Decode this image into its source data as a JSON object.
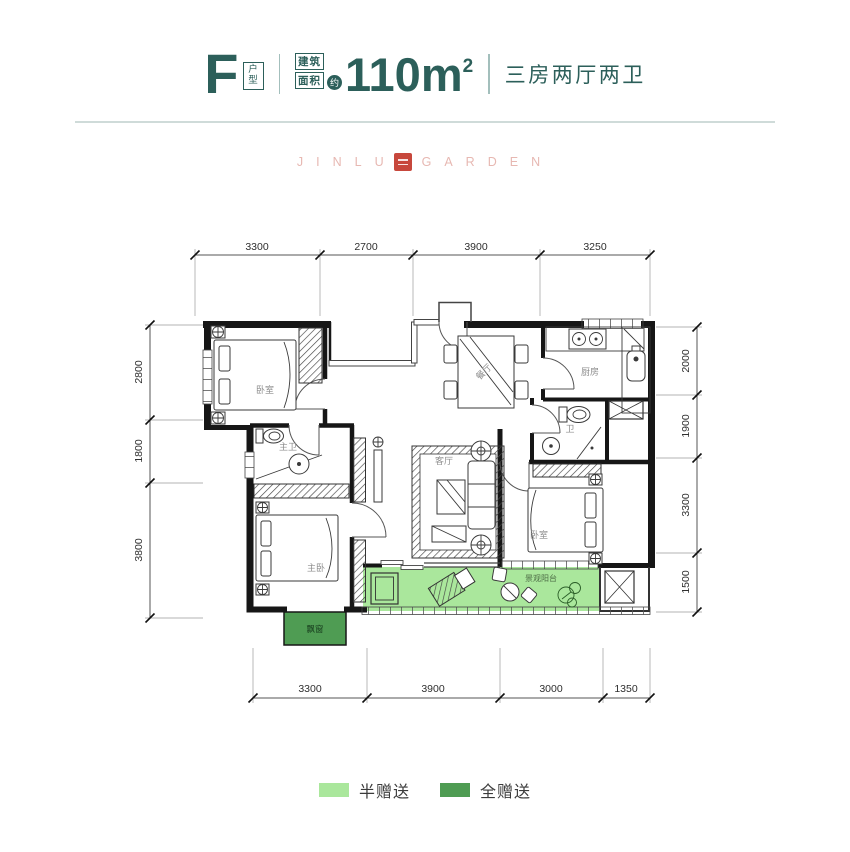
{
  "header": {
    "unit_letter": "F",
    "unit_suffix": "户型",
    "area_label_line1": "建筑",
    "area_label_line2": "面积",
    "area_approx": "约",
    "area_value": "110m",
    "area_exponent": "2",
    "layout": "三房两厅两卫"
  },
  "watermark": {
    "left": "JINLU",
    "right": "GARDEN"
  },
  "dims": {
    "top": [
      "3300",
      "2700",
      "3900",
      "3250"
    ],
    "bottom": [
      "3300",
      "3900",
      "3000",
      "1350"
    ],
    "left": [
      "2800",
      "1800",
      "3800"
    ],
    "right": [
      "2000",
      "1900",
      "3300",
      "1500"
    ]
  },
  "rooms": {
    "bedroom1": "卧室",
    "master_bath": "主卫",
    "dining": "餐厅",
    "kitchen": "厨房",
    "bath2": "卫",
    "living": "客厅",
    "master_bedroom": "主卧",
    "bedroom2": "卧室",
    "balcony": "景观阳台",
    "bay_window": "飘窗"
  },
  "legend": {
    "half": {
      "label": "半赠送",
      "color": "#aae79c"
    },
    "full": {
      "label": "全赠送",
      "color": "#4f9c53"
    }
  },
  "colors": {
    "accent_teal": "#2c5f5a",
    "wall_black": "#161616",
    "half_gift_green": "#aae79c",
    "full_gift_green": "#4f9c53",
    "watermark_pink": "#e7b8b2",
    "seal_red": "#c7473c",
    "dim_text": "#2f2f2f",
    "room_label_gray": "#8c8c8c"
  }
}
